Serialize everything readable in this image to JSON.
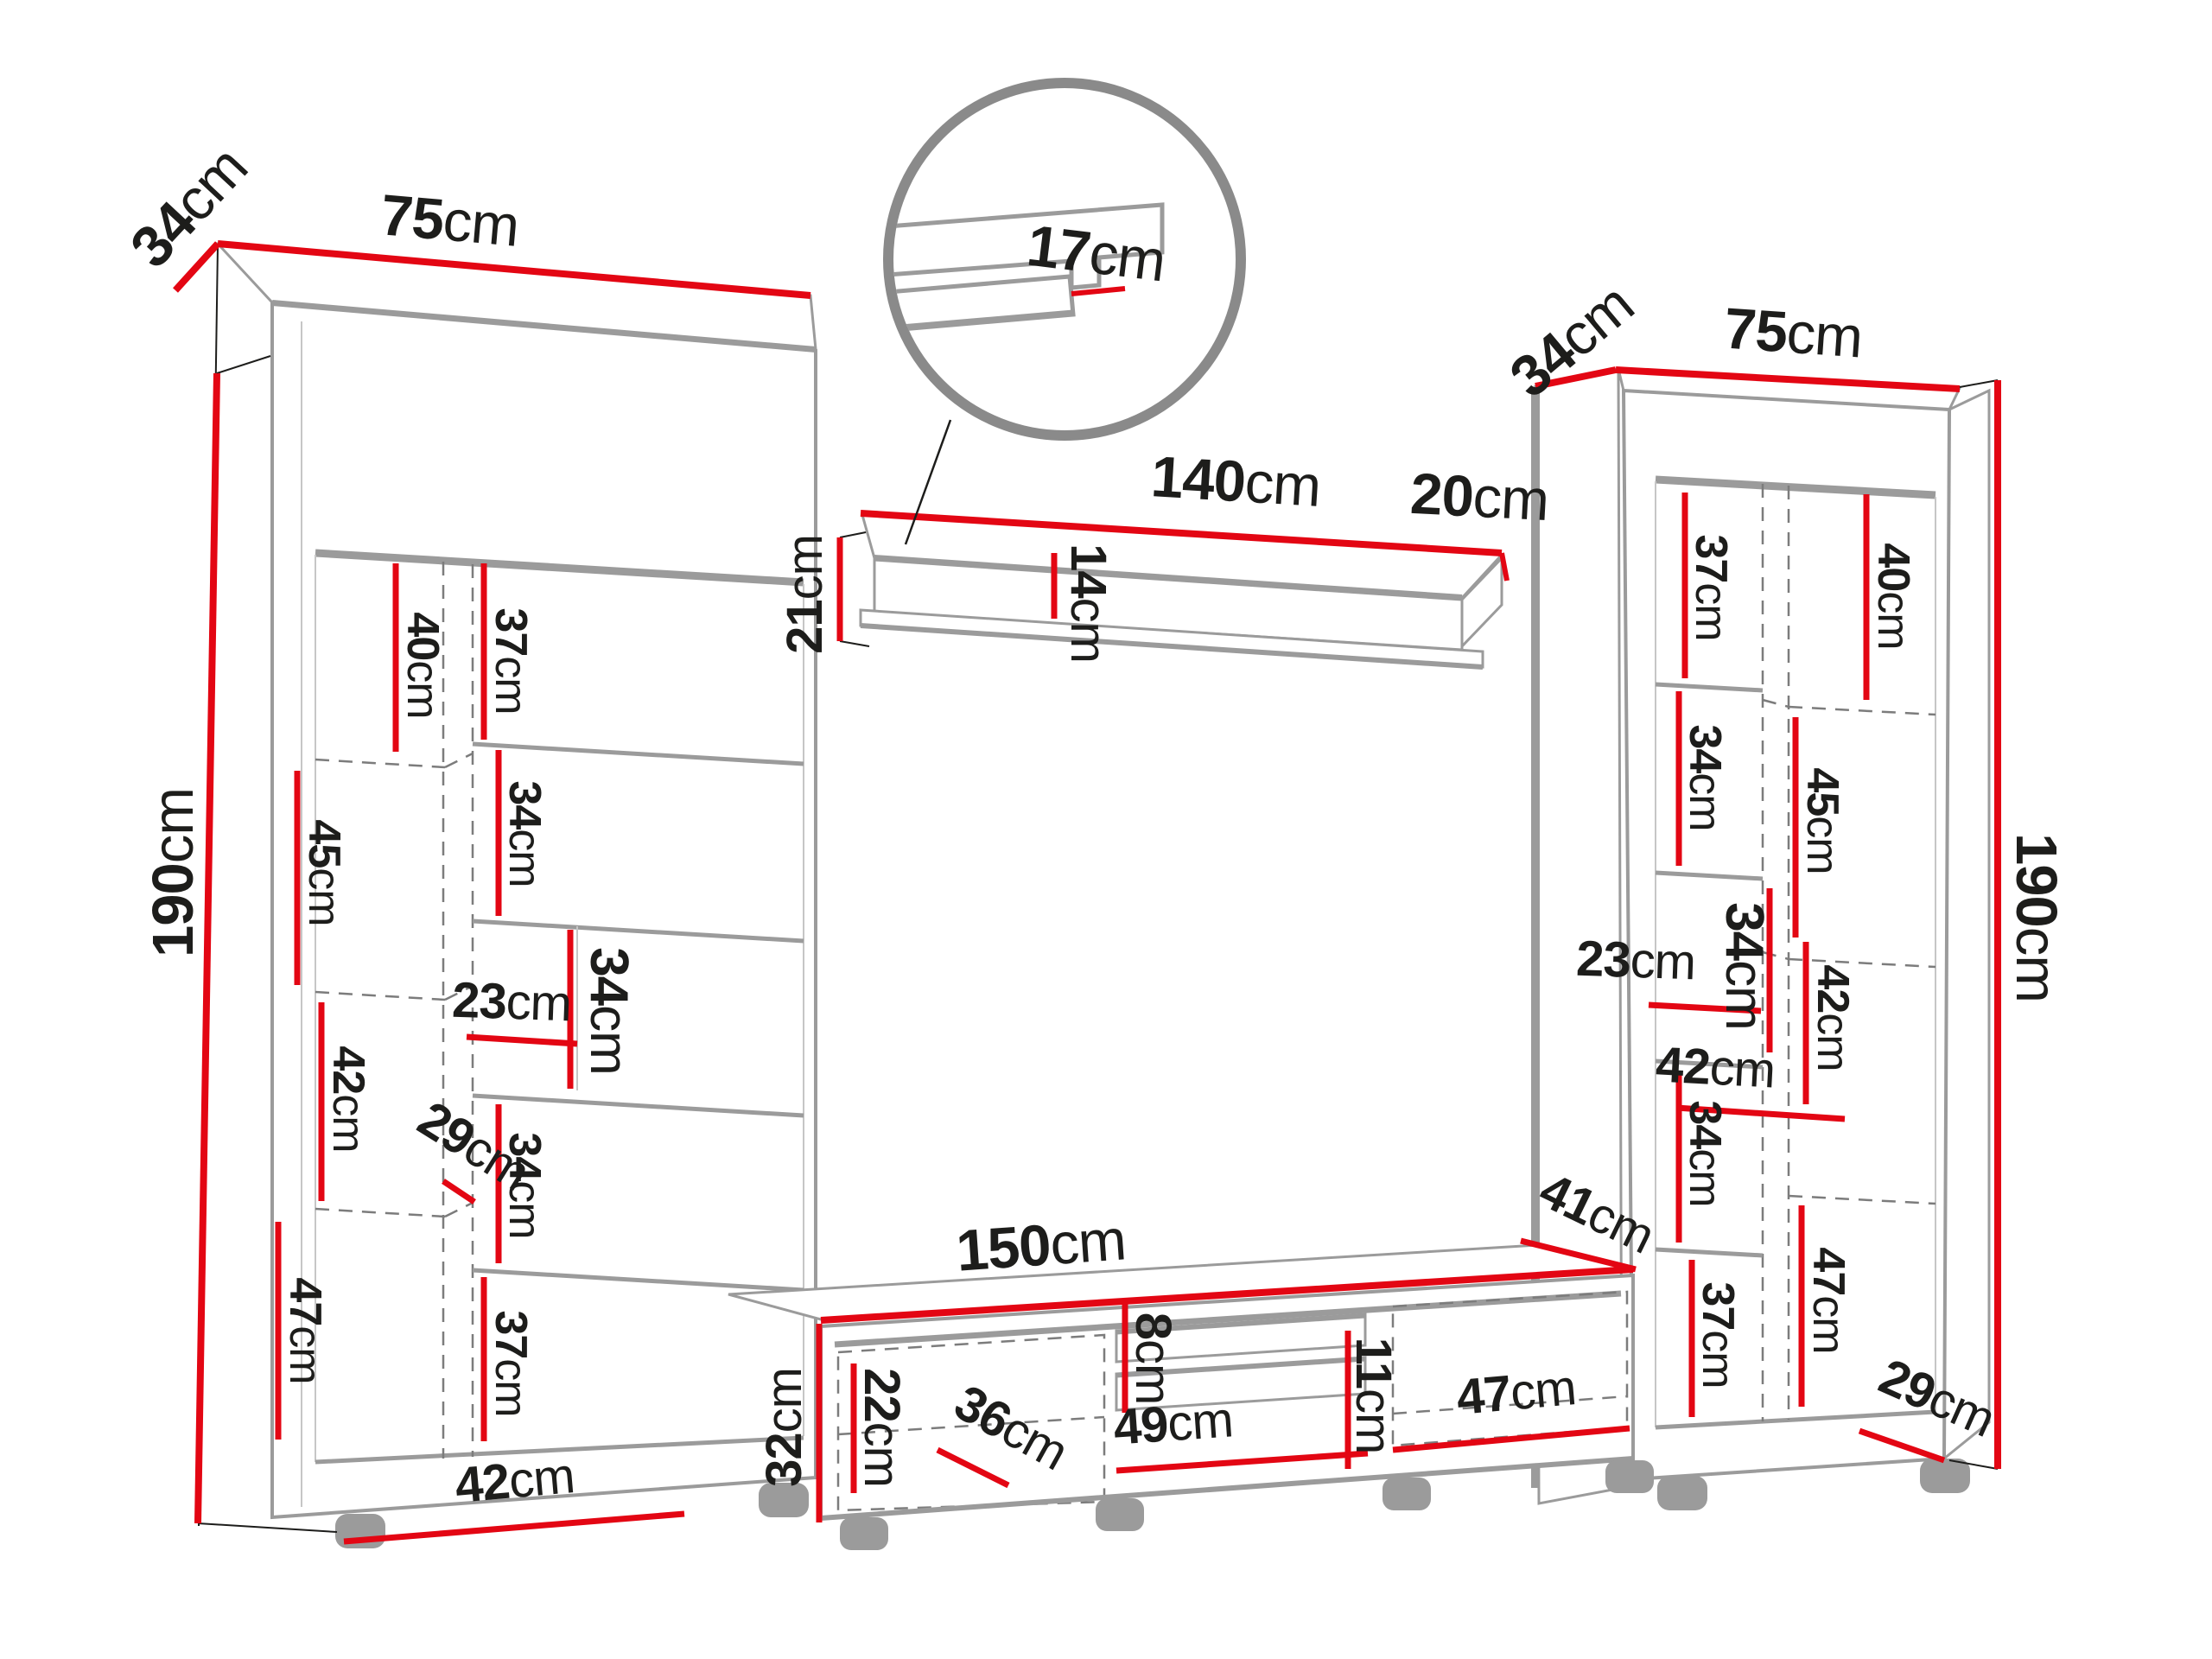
{
  "diagram": {
    "type": "furniture-dimension-drawing",
    "subject": "wall unit set: two tall cabinets, wall shelf and TV stand with dimensions",
    "unit": "cm",
    "colors": {
      "dimension_red": "#e30613",
      "outline_gray": "#9b9b9b",
      "text_black": "#1d1d1b"
    },
    "left_cabinet": {
      "depth": {
        "v": "34",
        "u": "cm"
      },
      "width": {
        "v": "75",
        "u": "cm"
      },
      "height": {
        "v": "190",
        "u": "cm"
      },
      "col_40": {
        "v": "40",
        "u": "cm"
      },
      "col_45": {
        "v": "45",
        "u": "cm"
      },
      "col_42": {
        "v": "42",
        "u": "cm"
      },
      "col_47": {
        "v": "47",
        "u": "cm"
      },
      "side_37_top": {
        "v": "37",
        "u": "cm"
      },
      "side_34_upper": {
        "v": "34",
        "u": "cm"
      },
      "side_34_middle": {
        "v": "34",
        "u": "cm"
      },
      "side_34_lower": {
        "v": "34",
        "u": "cm"
      },
      "side_37_bottom": {
        "v": "37",
        "u": "cm"
      },
      "niche_23": {
        "v": "23",
        "u": "cm"
      },
      "depth_29": {
        "v": "29",
        "u": "cm"
      },
      "door_42": {
        "v": "42",
        "u": "cm"
      }
    },
    "wall_shelf": {
      "length_140": {
        "v": "140",
        "u": "cm"
      },
      "end_depth_20": {
        "v": "20",
        "u": "cm"
      },
      "end_height_21": {
        "v": "21",
        "u": "cm"
      },
      "inner_14": {
        "v": "14",
        "u": "cm"
      },
      "detail_17": {
        "v": "17",
        "u": "cm"
      }
    },
    "tv_stand": {
      "width_150": {
        "v": "150",
        "u": "cm"
      },
      "depth_41": {
        "v": "41",
        "u": "cm"
      },
      "height_32": {
        "v": "32",
        "u": "cm"
      },
      "door_22": {
        "v": "22",
        "u": "cm"
      },
      "depth_36": {
        "v": "36",
        "u": "cm"
      },
      "niche_8": {
        "v": "8",
        "u": "cm"
      },
      "niche_49": {
        "v": "49",
        "u": "cm"
      },
      "niche_11": {
        "v": "11",
        "u": "cm"
      },
      "door_47": {
        "v": "47",
        "u": "cm"
      }
    },
    "right_cabinet": {
      "depth": {
        "v": "34",
        "u": "cm"
      },
      "width": {
        "v": "75",
        "u": "cm"
      },
      "height": {
        "v": "190",
        "u": "cm"
      },
      "col_40": {
        "v": "40",
        "u": "cm"
      },
      "col_45": {
        "v": "45",
        "u": "cm"
      },
      "col_42": {
        "v": "42",
        "u": "cm"
      },
      "col_47": {
        "v": "47",
        "u": "cm"
      },
      "side_37_top": {
        "v": "37",
        "u": "cm"
      },
      "side_34_upper": {
        "v": "34",
        "u": "cm"
      },
      "side_34_middle": {
        "v": "34",
        "u": "cm"
      },
      "side_34_lower": {
        "v": "34",
        "u": "cm"
      },
      "side_37_bottom": {
        "v": "37",
        "u": "cm"
      },
      "niche_23": {
        "v": "23",
        "u": "cm"
      },
      "width_42": {
        "v": "42",
        "u": "cm"
      },
      "depth_29": {
        "v": "29",
        "u": "cm"
      }
    }
  }
}
